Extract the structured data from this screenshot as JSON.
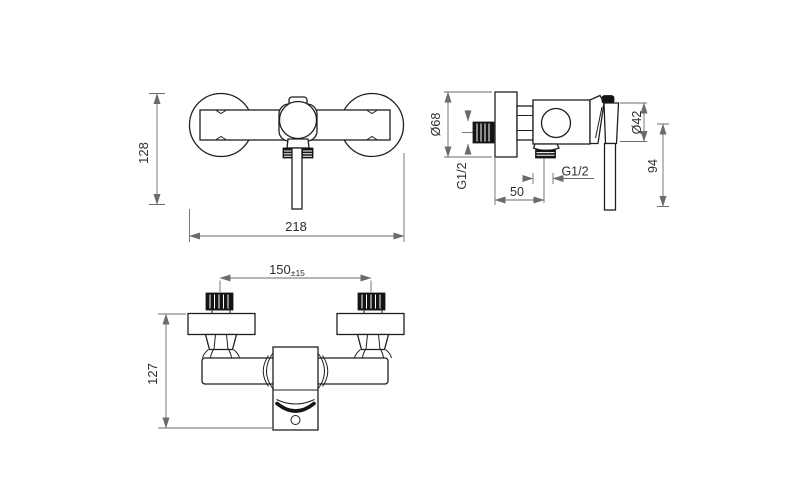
{
  "drawing": {
    "type": "technical-drawing",
    "subject": "wall-mounted-shower-mixer",
    "background": "#ffffff",
    "object_line_color": "#1f1f1f",
    "dimension_line_color": "#6b6b6b",
    "text_color": "#2e2e2e",
    "views": {
      "front": {
        "label": "front-view",
        "height_mm": "128",
        "width_mm": "218"
      },
      "side": {
        "label": "side-view",
        "plate_diameter": "Ø68",
        "inlet_thread": "G1/2",
        "outlet_thread": "G1/2",
        "wall_to_outlet": "50",
        "handle_diameter": "Ø42",
        "handle_length": "94"
      },
      "top": {
        "label": "top-view",
        "inlet_spacing": "150",
        "inlet_spacing_tolerance": "±15",
        "depth": "127"
      }
    }
  }
}
